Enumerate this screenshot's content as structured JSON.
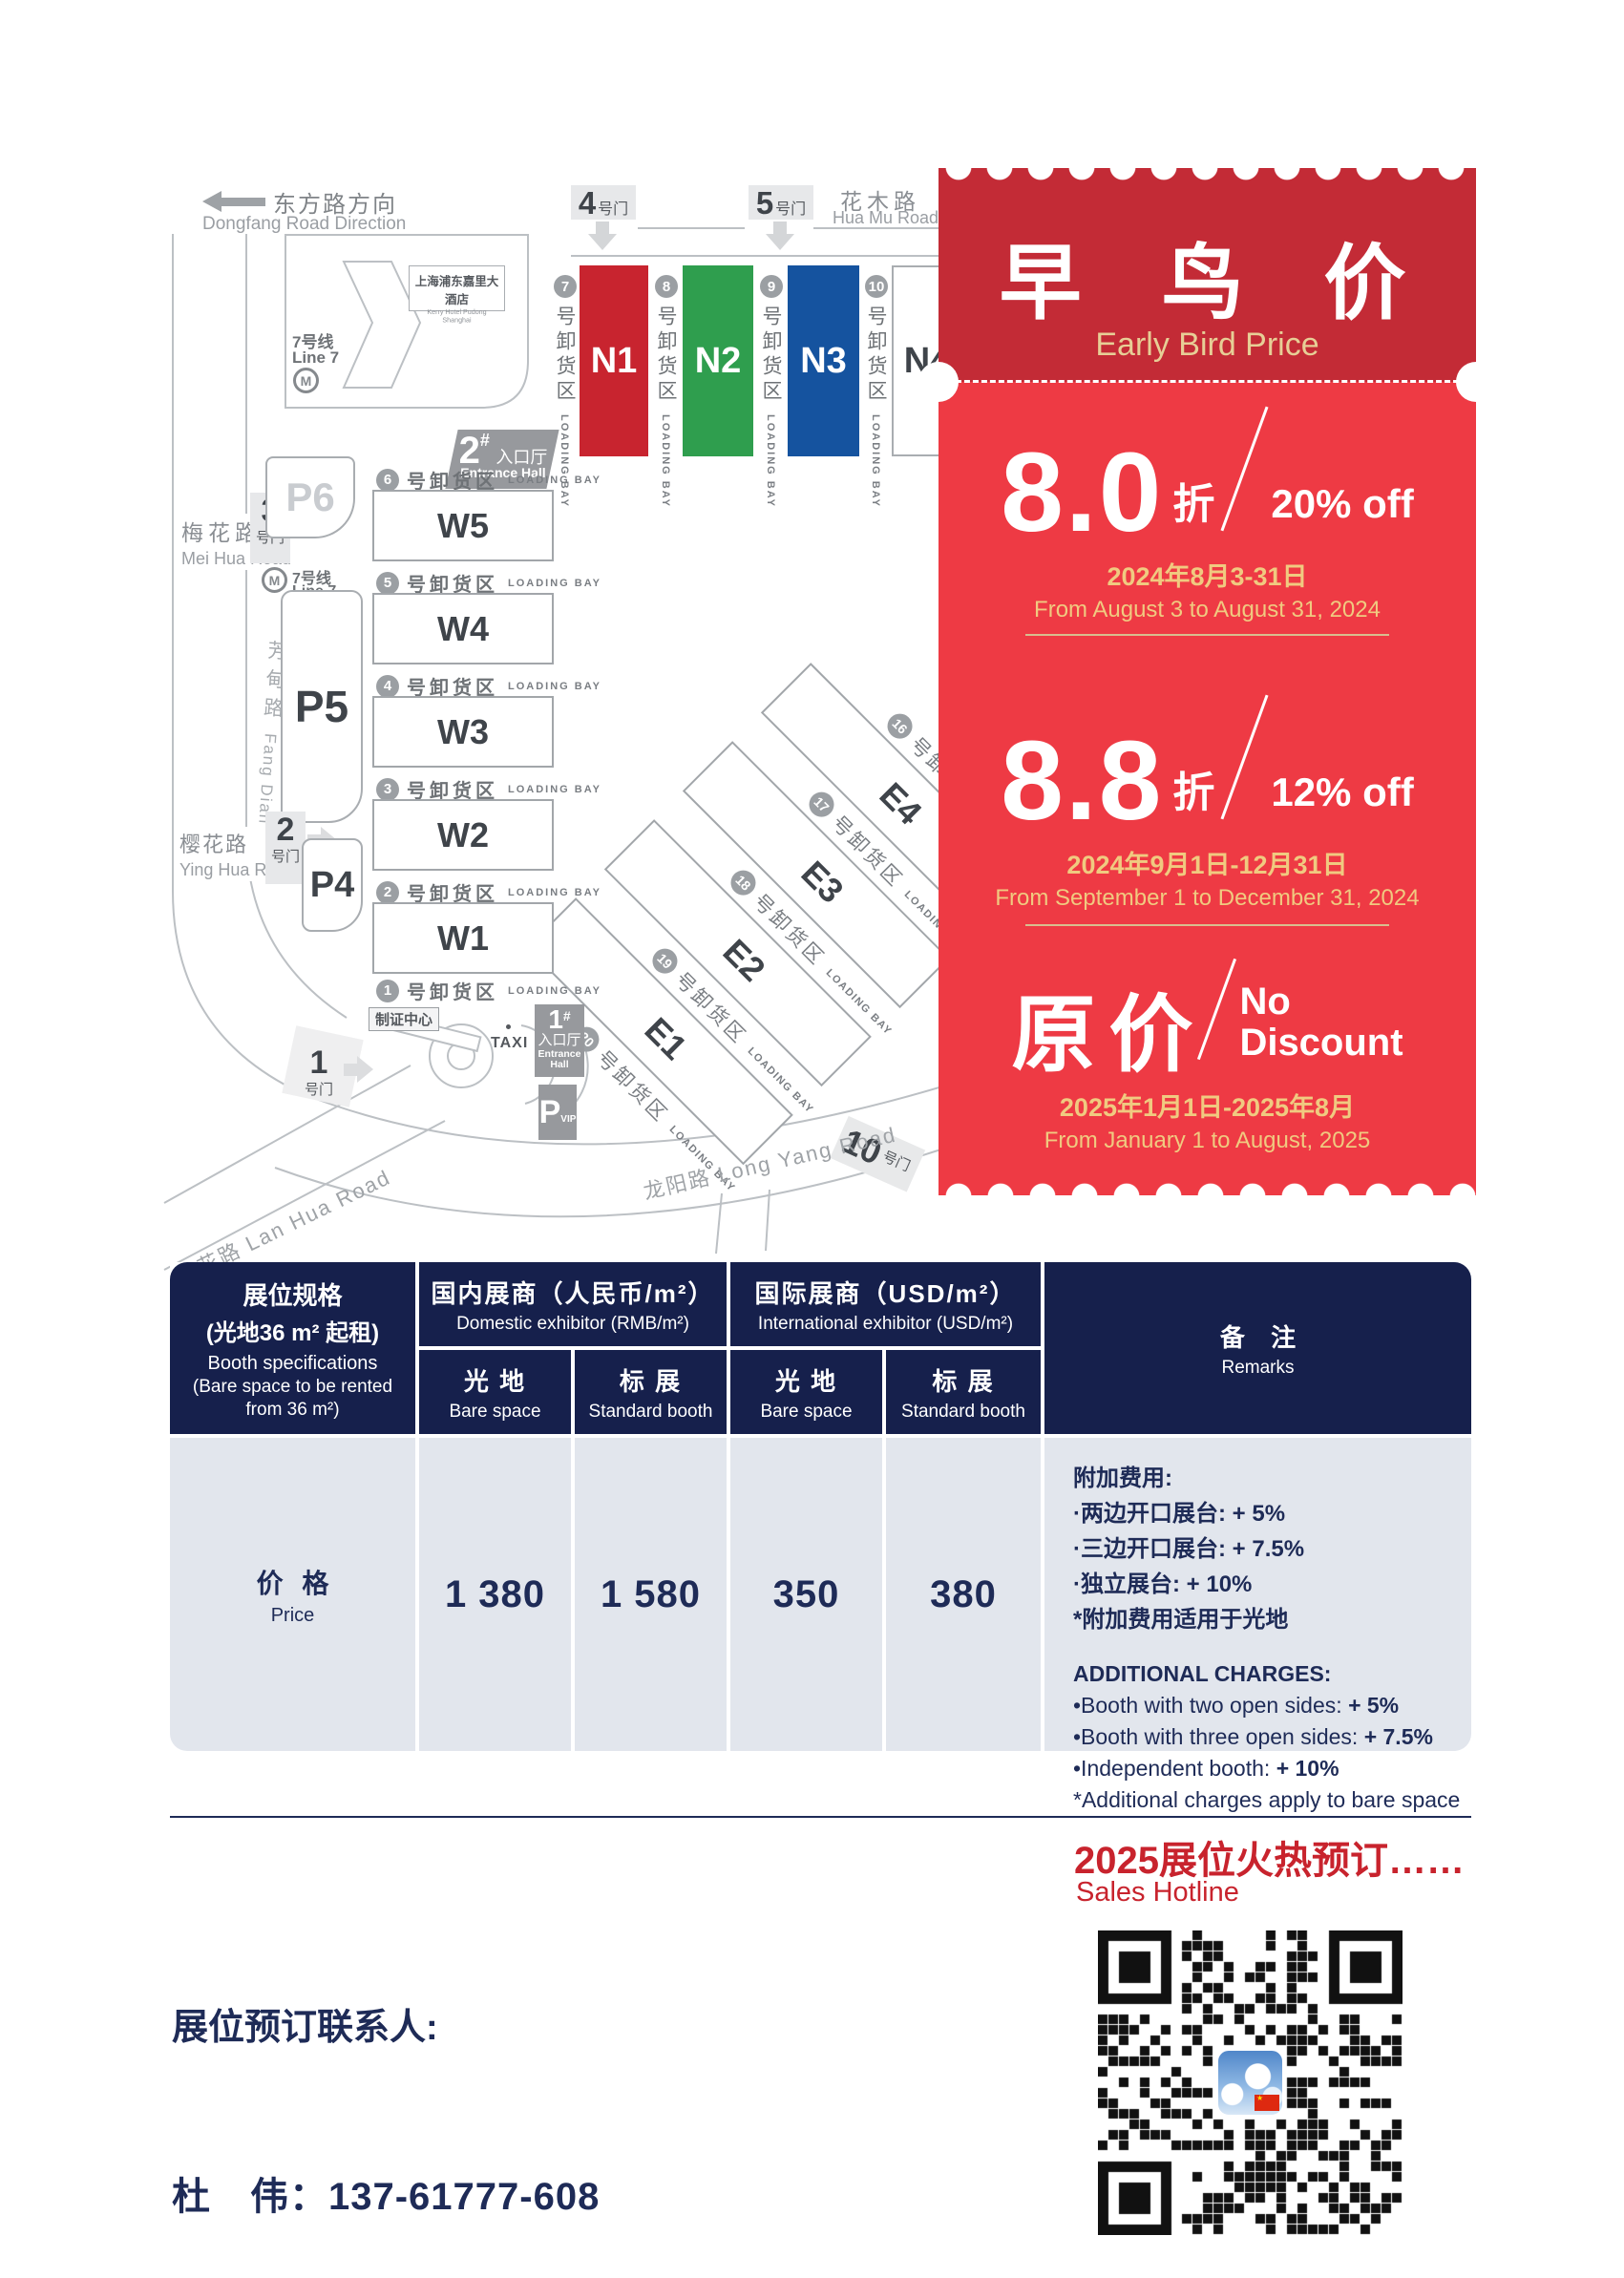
{
  "colors": {
    "brand_red": "#C8242F",
    "coupon_header_red": "#C32B36",
    "coupon_body_red": "#EE3A44",
    "coupon_gold": "#E7CE96",
    "coupon_date_gold": "#F0CA80",
    "table_header_navy": "#16204C",
    "text_navy": "#1E2B57",
    "table_body_gray": "#E2E6ED",
    "hall_green": "#2F9E4E",
    "hall_blue": "#15539F"
  },
  "map": {
    "direction_zh": "东方路方向",
    "direction_en": "Dongfang Road Direction",
    "hotel_zh": "上海浦东嘉里大酒店",
    "hotel_en": "Kerry Hotel Pudong Shanghai",
    "metro_zh": "7号线",
    "metro_en": "Line 7",
    "metro_m": "M",
    "huamu_zh": "花木路",
    "huamu_en": "Hua Mu Road",
    "meihua_zh": "梅花路",
    "meihua_en": "Mei Hua Road",
    "yinghua_zh": "樱花路",
    "yinghua_en": "Ying Hua Road",
    "fangdian_zh": "芳甸路",
    "fangdian_en": "Fang Dian Road",
    "lanhua": "兰花路 Lan Hua Road",
    "longyang": "龙阳路  Long Yang Road",
    "gate_suffix": "号门",
    "gate1": "1",
    "gate2": "2",
    "gate3": "3",
    "gate4": "4",
    "gate5": "5",
    "gate10": "10",
    "halls_n": [
      "N1",
      "N2",
      "N3",
      "N4"
    ],
    "halls_w": [
      "W5",
      "W4",
      "W3",
      "W2",
      "W1"
    ],
    "halls_e": [
      "E4",
      "E3",
      "E2",
      "E1"
    ],
    "bays_n": [
      "7",
      "8",
      "9",
      "10"
    ],
    "bays_w": [
      "6",
      "5",
      "4",
      "3",
      "2",
      "1"
    ],
    "bays_e": [
      "16",
      "17",
      "18",
      "19",
      "20"
    ],
    "loading_zh": "号卸货区",
    "loading_en": "LOADING BAY",
    "p6": "P6",
    "p5": "P5",
    "p4": "P4",
    "entrance2_num": "2",
    "entrance1_num": "1",
    "entrance_hash": "#",
    "entrance_zh": "入口厅",
    "entrance_en": "Entrance Hall",
    "vip_p": "P",
    "vip": "VIP",
    "taxi": "TAXI",
    "badge_center": "制证中心"
  },
  "coupon": {
    "title_zh": "早 鸟 价",
    "title_en": "Early Bird Price",
    "tiers": [
      {
        "big": "8.0",
        "zhe": "折",
        "off": "20% off",
        "date_zh": "2024年8月3-31日",
        "date_en": "From August 3 to August 31, 2024"
      },
      {
        "big": "8.8",
        "zhe": "折",
        "off": "12% off",
        "date_zh": "2024年9月1日-12月31日",
        "date_en": "From September 1 to December 31, 2024"
      },
      {
        "big": "原价",
        "off1": "No",
        "off2": "Discount",
        "date_zh": "2025年1月1日-2025年8月",
        "date_en": "From January 1 to August, 2025"
      }
    ]
  },
  "table": {
    "spec_zh1": "展位规格",
    "spec_zh2": "(光地36 m² 起租)",
    "spec_en1": "Booth specifications",
    "spec_en2": "(Bare space to be rented",
    "spec_en3": "from 36 m²)",
    "dom_zh": "国内展商（人民币/m²）",
    "dom_en": "Domestic exhibitor (RMB/m²)",
    "intl_zh": "国际展商（USD/m²）",
    "intl_en": "International exhibitor (USD/m²)",
    "bare_zh": "光 地",
    "bare_en": "Bare space",
    "std_zh": "标 展",
    "std_en": "Standard booth",
    "remarks_zh": "备 注",
    "remarks_en": "Remarks",
    "price_zh": "价 格",
    "price_en": "Price",
    "values": [
      "1 380",
      "1 580",
      "350",
      "380"
    ],
    "notes_zh": [
      {
        "t": "附加费用:",
        "b": ""
      },
      {
        "t": "·两边开口展台: ",
        "b": "+ 5%"
      },
      {
        "t": "·三边开口展台: ",
        "b": "+ 7.5%"
      },
      {
        "t": "·独立展台: ",
        "b": "+ 10%"
      },
      {
        "t": "*附加费用适用于光地",
        "b": ""
      }
    ],
    "notes_en": [
      {
        "t": "ADDITIONAL CHARGES:",
        "b": ""
      },
      {
        "t": "•Booth with two open sides: ",
        "b": "+ 5%"
      },
      {
        "t": "•Booth with three open sides: ",
        "b": "+ 7.5%"
      },
      {
        "t": "•Independent booth: ",
        "b": "+ 10%"
      },
      {
        "t": "*Additional charges apply to bare space",
        "b": ""
      }
    ]
  },
  "footer": {
    "sales_zh": "2025展位火热预订……",
    "sales_en": "Sales Hotline",
    "contact_label": "展位预订联系人:",
    "contact_phone": "杜　伟：137-61777-608"
  }
}
